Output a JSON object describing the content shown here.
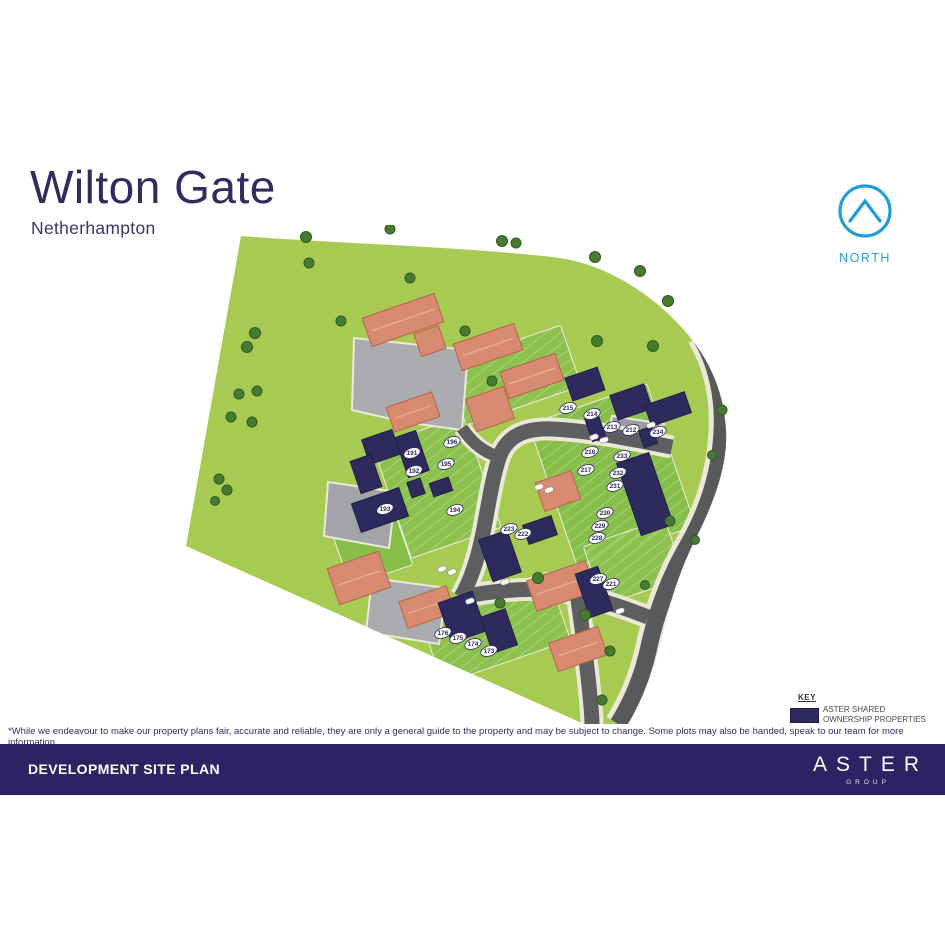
{
  "header": {
    "title": "Wilton Gate",
    "subtitle": "Netherhampton"
  },
  "compass": {
    "label": "NORTH",
    "color": "#1f9ed6"
  },
  "key": {
    "title": "KEY",
    "swatch_color": "#2f2a5e",
    "label_line1": "ASTER SHARED",
    "label_line2": "OWNERSHIP PROPERTIES"
  },
  "disclaimer": "*While we endeavour to make our property plans fair, accurate and reliable, they are only a general guide to the property and may be subject to change. Some plots may also be handed, speak to our team for more information.",
  "footer": {
    "title": "DEVELOPMENT SITE PLAN",
    "brand": "ASTER",
    "brand_sub": "GROUP"
  },
  "site_plan": {
    "plots": [
      {
        "n": "173",
        "x": 489,
        "y": 651
      },
      {
        "n": "174",
        "x": 473,
        "y": 644
      },
      {
        "n": "175",
        "x": 458,
        "y": 638
      },
      {
        "n": "176",
        "x": 443,
        "y": 633
      },
      {
        "n": "191",
        "x": 412,
        "y": 453
      },
      {
        "n": "192",
        "x": 414,
        "y": 471
      },
      {
        "n": "193",
        "x": 385,
        "y": 509
      },
      {
        "n": "194",
        "x": 455,
        "y": 510
      },
      {
        "n": "195",
        "x": 446,
        "y": 464
      },
      {
        "n": "196",
        "x": 452,
        "y": 442
      },
      {
        "n": "212",
        "x": 631,
        "y": 430
      },
      {
        "n": "213",
        "x": 612,
        "y": 427
      },
      {
        "n": "214",
        "x": 592,
        "y": 414
      },
      {
        "n": "215",
        "x": 568,
        "y": 408
      },
      {
        "n": "216",
        "x": 590,
        "y": 452
      },
      {
        "n": "217",
        "x": 586,
        "y": 470
      },
      {
        "n": "221",
        "x": 611,
        "y": 584
      },
      {
        "n": "222",
        "x": 523,
        "y": 534
      },
      {
        "n": "223",
        "x": 509,
        "y": 529
      },
      {
        "n": "227",
        "x": 598,
        "y": 579
      },
      {
        "n": "228",
        "x": 597,
        "y": 538
      },
      {
        "n": "229",
        "x": 600,
        "y": 526
      },
      {
        "n": "230",
        "x": 605,
        "y": 513
      },
      {
        "n": "231",
        "x": 615,
        "y": 486
      },
      {
        "n": "232",
        "x": 618,
        "y": 473
      },
      {
        "n": "233",
        "x": 622,
        "y": 456
      },
      {
        "n": "234",
        "x": 658,
        "y": 432
      }
    ]
  }
}
